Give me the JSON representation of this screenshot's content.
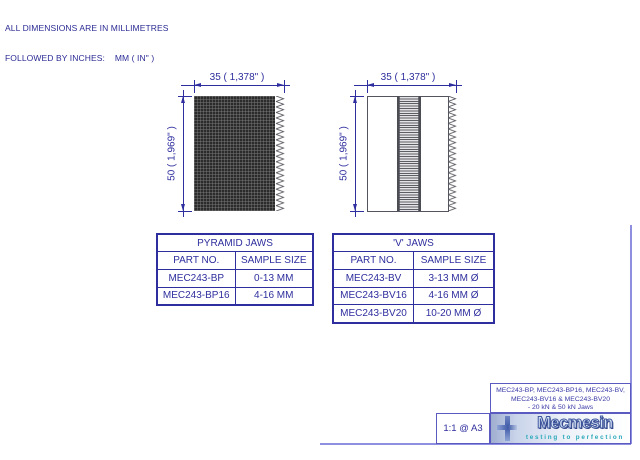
{
  "note": {
    "line1": "ALL DIMENSIONS ARE IN MILLIMETRES",
    "line2": "FOLLOWED BY INCHES:    MM ( IN\" )"
  },
  "drawings": {
    "pyramid": {
      "width_dim": "35 ( 1,378\" )",
      "height_dim": "50 ( 1,969\" )"
    },
    "vee": {
      "width_dim": "35 ( 1,378\" )",
      "height_dim": "50 ( 1,969\" )"
    }
  },
  "tables": {
    "pyramid": {
      "title": "PYRAMID JAWS",
      "col1": "PART NO.",
      "col2": "SAMPLE SIZE",
      "rows": [
        [
          "MEC243-BP",
          "0-13 MM"
        ],
        [
          "MEC243-BP16",
          "4-16 MM"
        ]
      ]
    },
    "vee": {
      "title": "'V' JAWS",
      "col1": "PART NO.",
      "col2": "SAMPLE SIZE",
      "rows": [
        [
          "MEC243-BV",
          "3-13 MM Ø"
        ],
        [
          "MEC243-BV16",
          "4-16 MM Ø"
        ],
        [
          "MEC243-BV20",
          "10-20 MM Ø"
        ]
      ]
    }
  },
  "title_block": {
    "description_line1": "MEC243-BP, MEC243-BP16, MEC243-BV,",
    "description_line2": "MEC243-BV16 & MEC243-BV20",
    "description_line3": "- 20 kN & 50 kN Jaws",
    "scale": "1:1 @ A3",
    "logo_text": "Mecmesin",
    "logo_tagline": "testing to perfection"
  },
  "colors": {
    "dimension_blue": "#2e2e9e",
    "note_blue": "#2b2b96",
    "frame_purple": "#8f8fdf",
    "logo_teal": "#29a9b9",
    "logo_navy": "#41589e"
  }
}
